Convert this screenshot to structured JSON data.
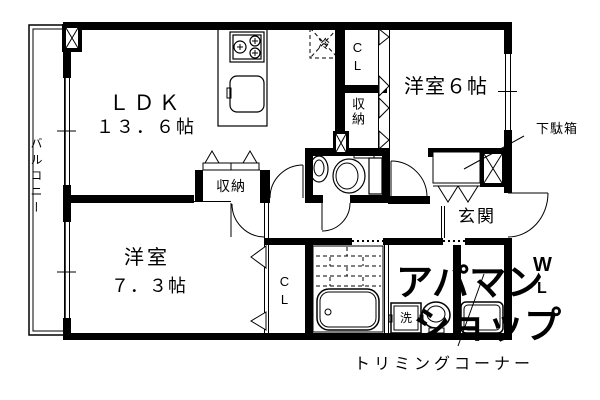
{
  "labels": {
    "balcony": "バルコニー",
    "ldk_name": "ＬＤＫ",
    "ldk_size": "１３．６帖",
    "room6": "洋室６帖",
    "room7_name": "洋室",
    "room7_size": "７．３帖",
    "entrance": "玄関",
    "shoe_cabinet": "下駄箱",
    "trimming_corner": "トリミングコーナー",
    "hall_storage": "収納",
    "column_storage": "収納",
    "closet_upper": "CL",
    "closet_lower": "CL",
    "refrigerator": "冷",
    "washer": "洗"
  },
  "rooms": [
    {
      "name": "ＬＤＫ",
      "size_jo": 13.6
    },
    {
      "name": "洋室",
      "size_jo": 6
    },
    {
      "name": "洋室",
      "size_jo": 7.3
    },
    {
      "name": "玄関"
    },
    {
      "name": "バルコニー"
    },
    {
      "name": "トリミングコーナー"
    }
  ],
  "watermark": {
    "line1": "アパマン",
    "line2": "ショップ",
    "mark_w": "W",
    "mark_l": "L",
    "color": "#c7c7c7"
  },
  "colors": {
    "line": "#000000",
    "background": "#ffffff"
  }
}
